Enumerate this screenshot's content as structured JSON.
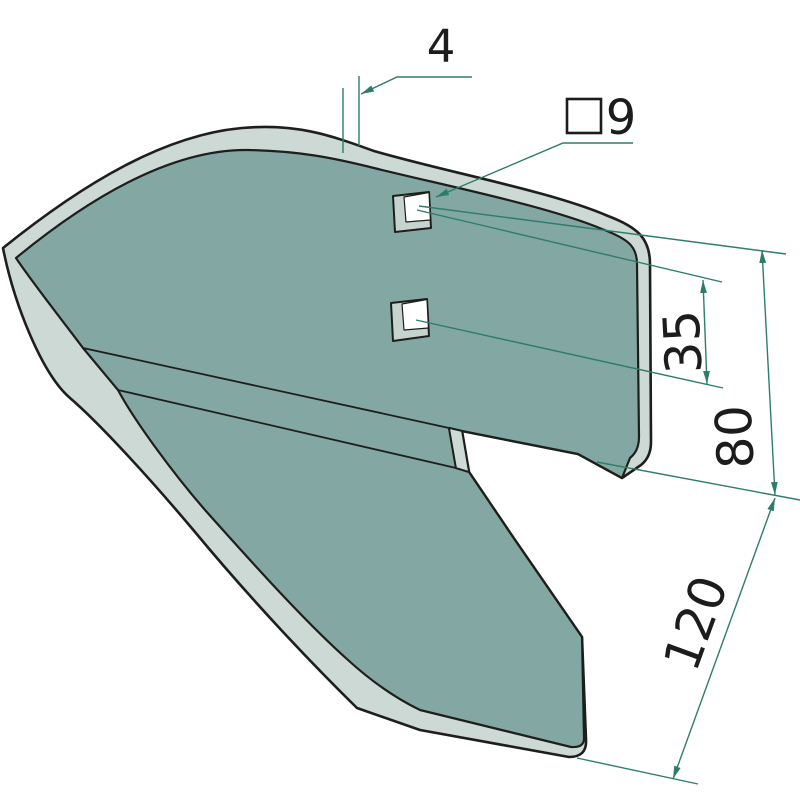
{
  "drawing": {
    "kind": "technical-isometric-part-drawing",
    "part": "share-plate-with-two-square-holes",
    "dimensions": {
      "thickness": {
        "label": "4"
      },
      "hole": {
        "symbol": "square",
        "label": "9"
      },
      "hole_pitch": {
        "label": "35"
      },
      "upper_span": {
        "label": "80"
      },
      "lower_span": {
        "label": "120"
      }
    },
    "colors": {
      "face": "#83a7a2",
      "edge": "#cdd9d5",
      "holeside": "#c6d4d0",
      "outline": "#1e1e1c",
      "dim": "#2e7d6c",
      "text": "#1c1c1c",
      "bg": "#ffffff"
    }
  }
}
